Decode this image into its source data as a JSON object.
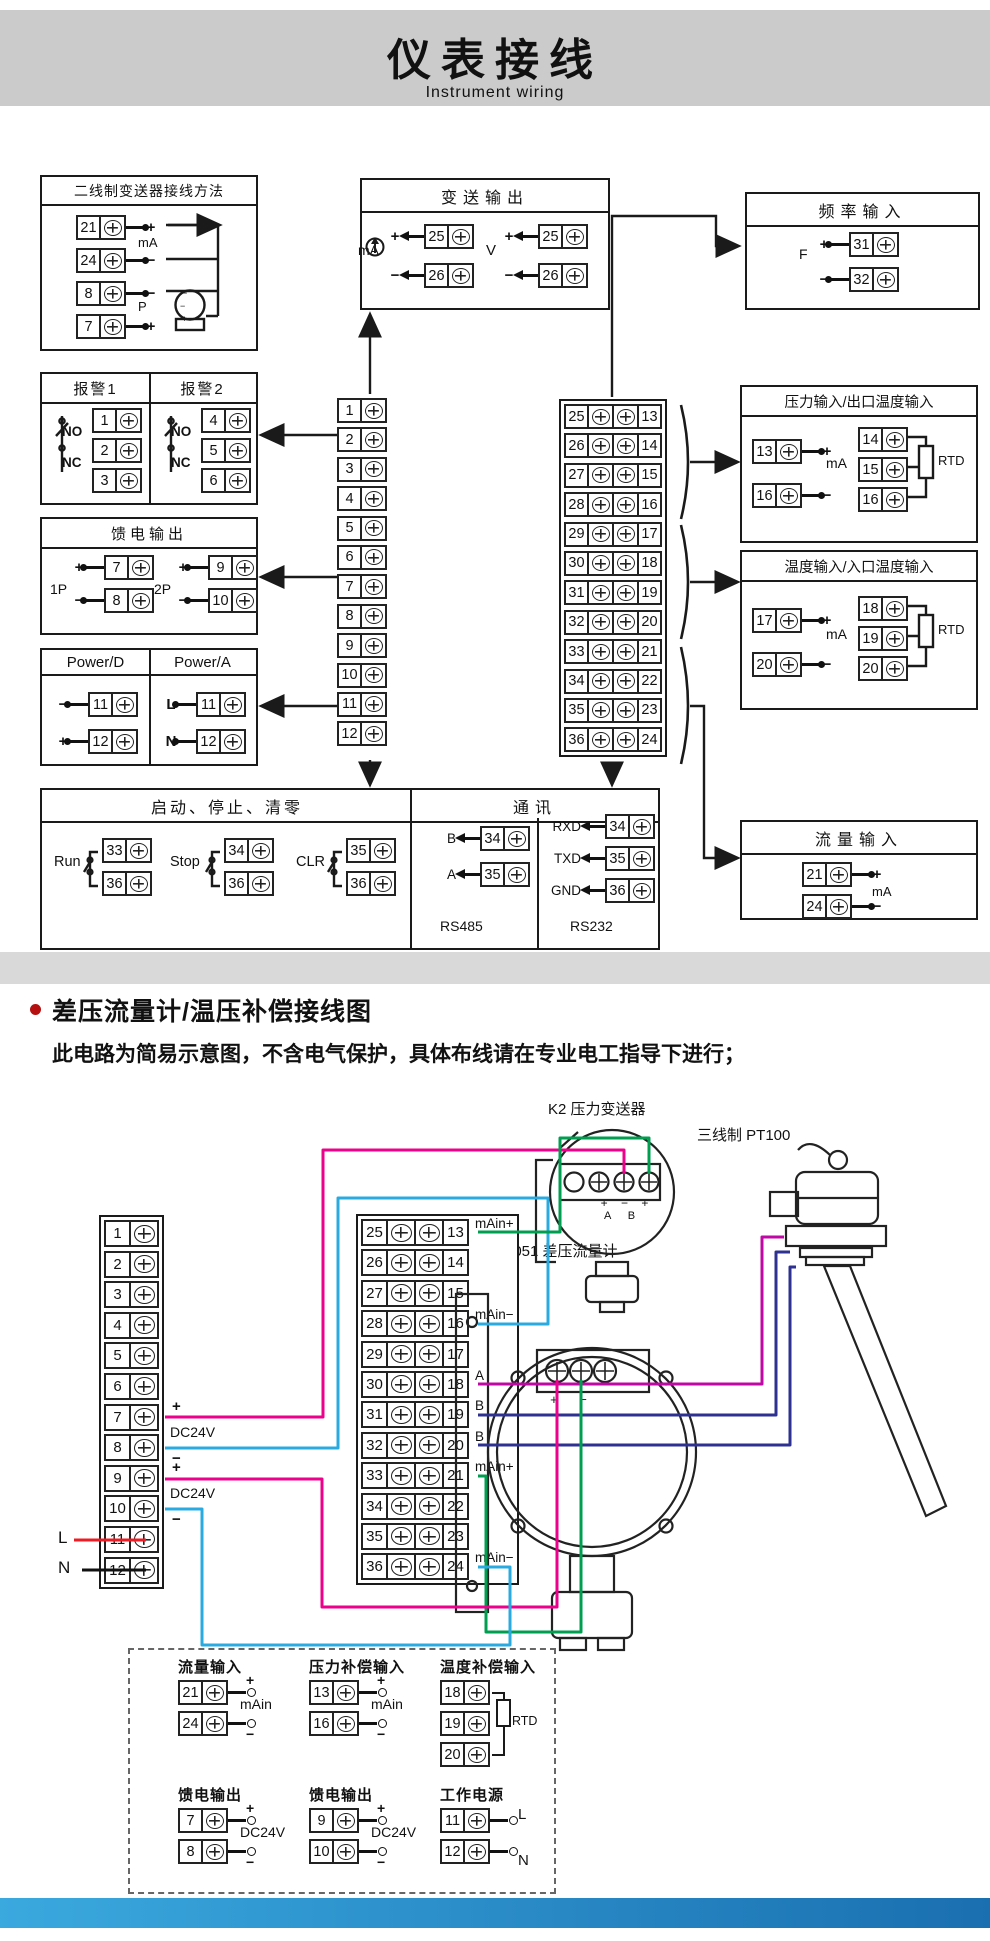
{
  "header": {
    "title": "仪表接线",
    "subtitle": "Instrument wiring"
  },
  "s1": {
    "boxA": {
      "title": "二线制变送器接线方法",
      "ma": "mA",
      "p": "P",
      "rows": [
        {
          "num": "21",
          "sign": "+"
        },
        {
          "num": "24",
          "sign": "−"
        },
        {
          "num": "8",
          "sign": "−"
        },
        {
          "num": "7",
          "sign": "+"
        }
      ],
      "tx": {
        "t": "−",
        "m": "−",
        "b": "+"
      }
    },
    "alarm": {
      "t1": "报警1",
      "t2": "报警2",
      "no1": "NO",
      "nc1": "NC",
      "no2": "NO",
      "nc2": "NC",
      "rows1": [
        "1",
        "2",
        "3"
      ],
      "rows2": [
        "4",
        "5",
        "6"
      ]
    },
    "feed": {
      "title": "馈电输出",
      "g1": "1P",
      "g2": "2P",
      "rows1": [
        {
          "sign": "+",
          "num": "7"
        },
        {
          "sign": "−",
          "num": "8"
        }
      ],
      "rows2": [
        {
          "sign": "+",
          "num": "9"
        },
        {
          "sign": "−",
          "num": "10"
        }
      ]
    },
    "power": {
      "t1": "Power/D",
      "t2": "Power/A",
      "rows1": [
        {
          "sign": "−",
          "num": "11"
        },
        {
          "sign": "+",
          "num": "12"
        }
      ],
      "rows2": [
        {
          "sign": "L",
          "num": "11"
        },
        {
          "sign": "N",
          "num": "12"
        }
      ]
    },
    "txout": {
      "title": "变送输出",
      "ma": "mA",
      "v": "V",
      "rows1": [
        {
          "sign": "+",
          "num": "25"
        },
        {
          "sign": "−",
          "num": "26"
        }
      ],
      "rows2": [
        {
          "sign": "+",
          "num": "25"
        },
        {
          "sign": "−",
          "num": "26"
        }
      ]
    },
    "freq": {
      "title": "频率输入",
      "f": "F",
      "rows": [
        {
          "sign": "+",
          "num": "31"
        },
        {
          "sign": "−",
          "num": "32"
        }
      ]
    },
    "pressin": {
      "title": "压力输入/出口温度输入",
      "ma": "mA",
      "rtd": "RTD",
      "rows1": [
        {
          "num": "13",
          "sign": "+"
        },
        {
          "num": "16",
          "sign": "−"
        }
      ],
      "rows2": [
        "14",
        "15",
        "16"
      ]
    },
    "tempin": {
      "title": "温度输入/入口温度输入",
      "ma": "mA",
      "rtd": "RTD",
      "rows1": [
        {
          "num": "17",
          "sign": "+"
        },
        {
          "num": "20",
          "sign": "−"
        }
      ],
      "rows2": [
        "18",
        "19",
        "20"
      ]
    },
    "flowin": {
      "title": "流量输入",
      "ma": "mA",
      "rows": [
        {
          "num": "21",
          "sign": "+"
        },
        {
          "num": "24",
          "sign": "−"
        }
      ]
    },
    "runbox": {
      "title": "启动、停止、清零",
      "g1": {
        "label": "Run",
        "a": "33",
        "b": "36"
      },
      "g2": {
        "label": "Stop",
        "a": "34",
        "b": "36"
      },
      "g3": {
        "label": "CLR",
        "a": "35",
        "b": "36"
      }
    },
    "comm": {
      "title": "通讯",
      "rs485": {
        "label": "RS485",
        "rows": [
          {
            "sig": "B",
            "num": "34"
          },
          {
            "sig": "A",
            "num": "35"
          }
        ]
      },
      "rs232": {
        "label": "RS232",
        "rows": [
          {
            "sig": "RXD",
            "num": "34"
          },
          {
            "sig": "TXD",
            "num": "35"
          },
          {
            "sig": "GND",
            "num": "36"
          }
        ]
      }
    },
    "stripL": [
      "1",
      "2",
      "3",
      "4",
      "5",
      "6",
      "7",
      "8",
      "9",
      "10",
      "11",
      "12"
    ],
    "stripR": [
      {
        "l": "25",
        "r": "13"
      },
      {
        "l": "26",
        "r": "14"
      },
      {
        "l": "27",
        "r": "15"
      },
      {
        "l": "28",
        "r": "16"
      },
      {
        "l": "29",
        "r": "17"
      },
      {
        "l": "30",
        "r": "18"
      },
      {
        "l": "31",
        "r": "19"
      },
      {
        "l": "32",
        "r": "20"
      },
      {
        "l": "33",
        "r": "21"
      },
      {
        "l": "34",
        "r": "22"
      },
      {
        "l": "35",
        "r": "23"
      },
      {
        "l": "36",
        "r": "24"
      }
    ]
  },
  "s2": {
    "title": "差压流量计/温压补偿接线图",
    "note": "此电路为简易示意图，不含电气保护，具体布线请在专业电工指导下进行；",
    "k2_label": "K2 压力变送器",
    "pt100_label": "三线制 PT100",
    "d3051_label": "3051 差压流量计",
    "k2_pins": "+ − +",
    "k2_pins2": "A B",
    "d3051_pins": "+ −",
    "stripL": [
      "1",
      "2",
      "3",
      "4",
      "5",
      "6",
      "7",
      "8",
      "9",
      "10",
      "11",
      "12"
    ],
    "labels": {
      "p1": "+",
      "dc1": "DC24V",
      "m1": "−",
      "p2": "+",
      "dc2": "DC24V",
      "m2": "−",
      "line": "L",
      "neutral": "N"
    },
    "stripR": [
      {
        "l": "25",
        "r": "13",
        "tag": "mAin+"
      },
      {
        "l": "26",
        "r": "14"
      },
      {
        "l": "27",
        "r": "15"
      },
      {
        "l": "28",
        "r": "16",
        "tag": "mAin−"
      },
      {
        "l": "29",
        "r": "17"
      },
      {
        "l": "30",
        "r": "18",
        "tag": "A"
      },
      {
        "l": "31",
        "r": "19",
        "tag": "B"
      },
      {
        "l": "32",
        "r": "20",
        "tag": "B"
      },
      {
        "l": "33",
        "r": "21",
        "tag": "mAin+"
      },
      {
        "l": "34",
        "r": "22"
      },
      {
        "l": "35",
        "r": "23"
      },
      {
        "l": "36",
        "r": "24",
        "tag": "mAin−"
      }
    ],
    "minis": {
      "flow": {
        "title": "流量输入",
        "rows": [
          "21",
          "24"
        ],
        "top": "+",
        "mid": "mAin",
        "bot": "−"
      },
      "pcomp": {
        "title": "压力补偿输入",
        "rows": [
          "13",
          "16"
        ],
        "top": "+",
        "mid": "mAin",
        "bot": "−"
      },
      "tcomp": {
        "title": "温度补偿输入",
        "rows": [
          "18",
          "19",
          "20"
        ],
        "rtd": "RTD"
      },
      "feed1": {
        "title": "馈电输出",
        "rows": [
          "7",
          "8"
        ],
        "top": "+",
        "mid": "DC24V",
        "bot": "−"
      },
      "feed2": {
        "title": "馈电输出",
        "rows": [
          "9",
          "10"
        ],
        "top": "+",
        "mid": "DC24V",
        "bot": "−"
      },
      "pwr": {
        "title": "工作电源",
        "rows": [
          "11",
          "12"
        ],
        "top": "L",
        "bot": "N"
      }
    }
  },
  "colors": {
    "header_bg": "#cbcbcb",
    "line": "#1a1a1a",
    "wire_red": "#ed1c24",
    "wire_black": "#111111",
    "wire_magenta": "#ec008c",
    "wire_cyan": "#29abe2",
    "wire_green": "#009e4f",
    "wire_navy": "#2e3192",
    "wire_purple": "#c008a6",
    "footer_blue": "#2d9fd6"
  }
}
